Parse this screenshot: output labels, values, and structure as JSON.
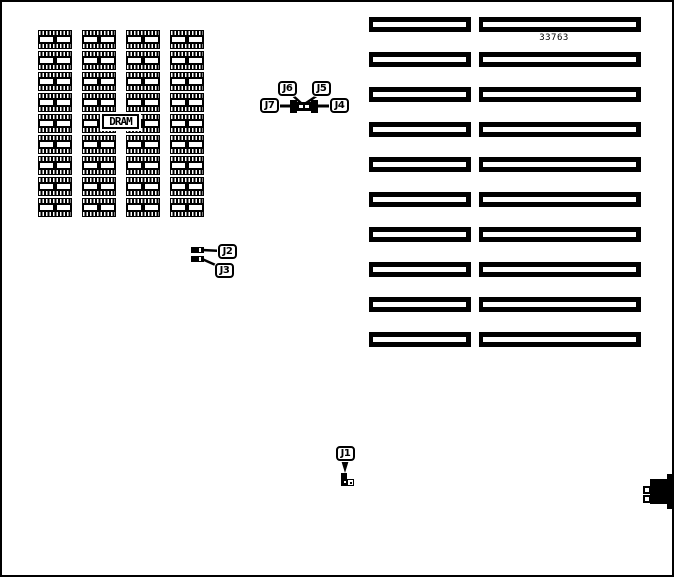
{
  "board": {
    "part_number": "33763",
    "dram_label": "DRAM",
    "dram_grid": {
      "rows": 9,
      "cols": 4
    },
    "slot_rows": 10,
    "jumper_labels": {
      "j1": "J1",
      "j2": "J2",
      "j3": "J3",
      "j4": "J4",
      "j5": "J5",
      "j6": "J6",
      "j7": "J7"
    },
    "colors": {
      "ink": "#000000",
      "paper": "#ffffff"
    }
  }
}
